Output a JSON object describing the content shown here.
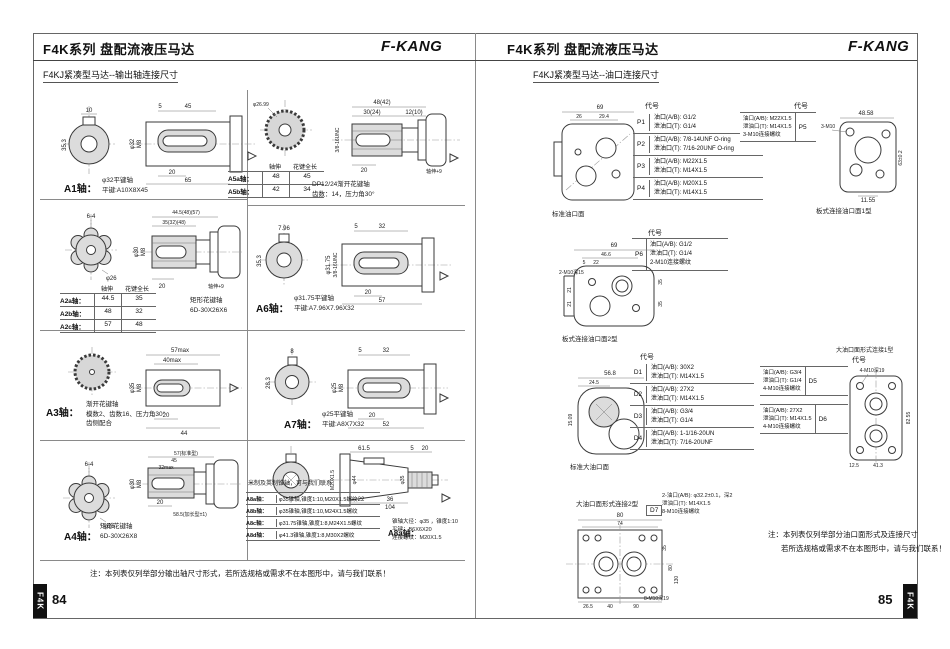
{
  "left": {
    "title": "F4K系列 盘配流液压马达",
    "brand": "F-KANG",
    "subtitle": "F4KJ紧凑型马达--输出轴连接尺寸",
    "page_number": "84",
    "tab": "F4K",
    "a1": {
      "label": "A1轴：",
      "desc1": "φ32平键轴",
      "desc2": "平键:A10X8X45",
      "dims": [
        "10",
        "35.3",
        "5",
        "45",
        "φ32",
        "M8",
        "20",
        "65"
      ]
    },
    "a2": {
      "headers": [
        "轴伸",
        "花键全长"
      ],
      "rows": [
        {
          "label": "A2a轴：",
          "v1": "44.5",
          "v2": "35"
        },
        {
          "label": "A2b轴：",
          "v1": "48",
          "v2": "32"
        },
        {
          "label": "A2c轴：",
          "v1": "57",
          "v2": "48"
        }
      ],
      "desc1": "矩形花键轴",
      "desc2": "6D-30X26X6",
      "dims": [
        "6-4",
        "φ26",
        "44.5(48)(57)",
        "35(32)(48)",
        "φ30",
        "M8",
        "20",
        "轴伸+9"
      ]
    },
    "a3": {
      "label": "A3轴：",
      "desc1": "渐开花键轴",
      "desc2": "模数2、齿数16、压力角30°",
      "desc3": "齿侧配合",
      "dims": [
        "57max",
        "40max",
        "φ35",
        "M8",
        "20",
        "44"
      ]
    },
    "a4": {
      "label": "A4轴：",
      "desc1": "矩形花键轴",
      "desc2": "6D-30X26X8",
      "dims": [
        "6-4",
        "φ26",
        "57(标准型)",
        "45",
        "32max",
        "φ30",
        "M8",
        "20",
        "58.5(加长型±1)"
      ]
    },
    "a5": {
      "headers": [
        "轴伸",
        "花键全长"
      ],
      "rows": [
        {
          "label": "A5a轴：",
          "v1": "48",
          "v2": "45"
        },
        {
          "label": "A5b轴：",
          "v1": "42",
          "v2": "34"
        }
      ],
      "desc1": "DP12/24渐开花键轴",
      "desc2": "齿数：14，压力角30°",
      "dims": [
        "φ26.99",
        "48(42)",
        "30(24)",
        "12(10)",
        "3/8-16UNC",
        "20",
        "轴伸+9"
      ]
    },
    "a6": {
      "label": "A6轴：",
      "desc1": "φ31.75平键轴",
      "desc2": "平键:A7.96X7.96X32",
      "dims": [
        "7.96",
        "35.3",
        "5",
        "32",
        "φ31.75",
        "3/8-16UNC",
        "20",
        "57"
      ]
    },
    "a7": {
      "label": "A7轴：",
      "desc1": "φ25平键轴",
      "desc2": "平键:A8X7X32",
      "dims": [
        "8",
        "28.3",
        "5",
        "32",
        "φ25",
        "M8",
        "20",
        "52"
      ]
    },
    "a8": {
      "note": "米制及英制锥轴，可与我们联系",
      "rows": [
        {
          "label": "A8a轴：",
          "text": "φ35锥轴,锥度1:10,M20X1.5螺纹"
        },
        {
          "label": "A8b轴：",
          "text": "φ35锥轴,锥度1:10,M24X1.5螺纹"
        },
        {
          "label": "A8c轴：",
          "text": "φ31.75锥轴,锥度1:8,M24X1.5螺纹"
        },
        {
          "label": "A8d轴：",
          "text": "φ41.3锥轴,锥度1:8,M30X2螺纹"
        }
      ],
      "detail_label": "A8a轴：",
      "detail1": "锥轴大径：φ35 ，锥度1:10",
      "detail2": "平键：B6X6X20",
      "detail3": "连接螺纹：M20X1.5",
      "dims": [
        "61.5",
        "5",
        "20",
        "M20X1.5",
        "φ44",
        "φ35",
        "22",
        "36",
        "104"
      ]
    },
    "note": "注：本列表仅列举部分输出轴尺寸形式，若所选规格或需求不在本图形中，请与我们联系！"
  },
  "right": {
    "title": "F4K系列 盘配流液压马达",
    "brand": "F-KANG",
    "subtitle": "F4KJ紧凑型马达--油口连接尺寸",
    "page_number": "85",
    "tab": "F4K",
    "code_header": "代号",
    "p_table": [
      {
        "code": "P1",
        "line1": "油口(A/B): G1/2",
        "line2": "泄油口(T): G1/4"
      },
      {
        "code": "P2",
        "line1": "油口(A/B): 7/8-14UNF O-ring",
        "line2": "泄油口(T): 7/16-20UNF O-ring"
      },
      {
        "code": "P3",
        "line1": "油口(A/B): M22X1.5",
        "line2": "泄油口(T): M14X1.5"
      },
      {
        "code": "P4",
        "line1": "油口(A/B): M20X1.5",
        "line2": "泄油口(T): M14X1.5"
      }
    ],
    "p5": {
      "code": "P5",
      "line1": "油口(A/B): M22X1.5",
      "line2": "泄油口(T): M14X1.5",
      "line3": "3-M10连接螺纹"
    },
    "p6": {
      "code": "P6",
      "line1": "油口(A/B): G1/2",
      "line2": "泄油口(T): G1/4",
      "line3": "2-M10连接螺纹"
    },
    "d_table": [
      {
        "code": "D1",
        "line1": "油口(A/B): 30X2",
        "line2": "泄油口(T): M14X1.5"
      },
      {
        "code": "D2",
        "line1": "油口(A/B): 27X2",
        "line2": "泄油口(T): M14X1.5"
      },
      {
        "code": "D3",
        "line1": "油口(A/B): G3/4",
        "line2": "泄油口(T): G1/4"
      },
      {
        "code": "D4",
        "line1": "油口(A/B): 1-1/16-20UN",
        "line2": "泄油口(T): 7/16-20UNF"
      }
    ],
    "d5": {
      "code": "D5",
      "line1": "油口(A/B): G3/4",
      "line2": "泄油口(T): G1/4",
      "line3": "4-M10连接螺纹"
    },
    "d6": {
      "code": "D6",
      "line1": "油口(A/B): 27X2",
      "line2": "泄油口(T): M14X1.5",
      "line3": "4-M10连接螺纹"
    },
    "d7": {
      "code": "D7",
      "line1": "2-油口(A/B): φ32.2±0.1，深2",
      "line2": "泄油口(T): M14X1.5",
      "line3": "8-M10连接螺纹"
    },
    "captions": {
      "std_port": "标准油口面",
      "plate1": "板式连接油口面1型",
      "plate2": "板式连接油口面2型",
      "std_big": "标准大油口面",
      "big1": "大油口面形式连接1型",
      "big2": "大油口面形式连接2型"
    },
    "top_dims": [
      "69",
      "26",
      "29.4"
    ],
    "plate1_dims": [
      "48.58",
      "11.55",
      "3-M10",
      "63±0.2"
    ],
    "plate2_dims": [
      "69",
      "46.6",
      "5",
      "22",
      "2-M10深15",
      "21",
      "21",
      "35",
      "35"
    ],
    "stdbig_dims": [
      "56.8",
      "24.5",
      "15.09"
    ],
    "big1_dims": [
      "82.55",
      "41.3",
      "12.5",
      "4-M10深19"
    ],
    "big2_dims": [
      "80",
      "74",
      "26.5",
      "40",
      "90",
      "35",
      "80",
      "130",
      "8-M10深19"
    ],
    "note1": "注：本列表仅列举部分油口面形式及连接尺寸",
    "note2": "若所选规格或需求不在本图形中，请与我们联系！"
  }
}
